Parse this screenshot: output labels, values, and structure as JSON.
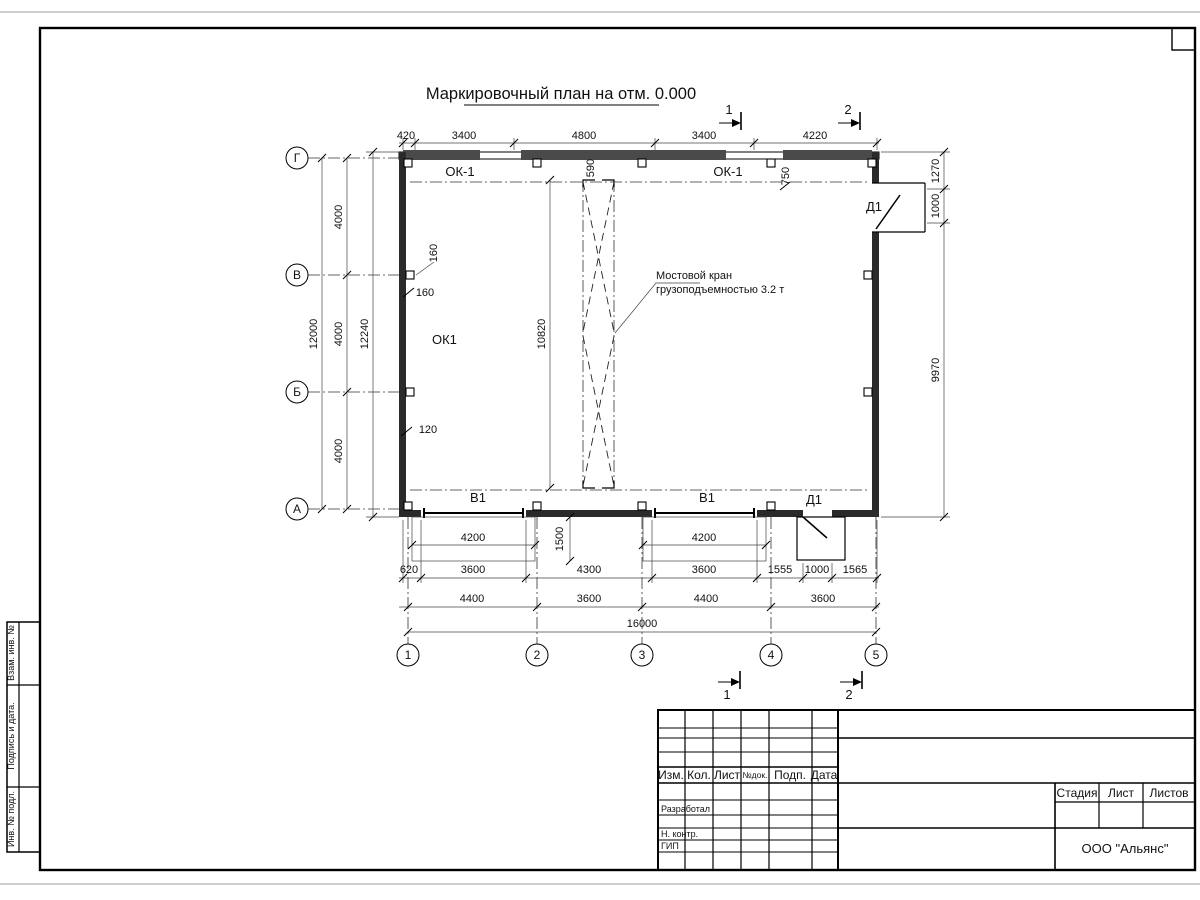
{
  "page": {
    "title": "Маркировочный план на отм. 0.000"
  },
  "axes": {
    "rows": [
      "Г",
      "В",
      "Б",
      "А"
    ],
    "cols": [
      "1",
      "2",
      "3",
      "4",
      "5"
    ]
  },
  "dims": {
    "top": [
      "420",
      "3400",
      "4800",
      "3400",
      "4220"
    ],
    "left_total": "12000",
    "left_segs": [
      "4000",
      "4000",
      "4000"
    ],
    "left_outer": "12240",
    "right": [
      "1270",
      "1000",
      "9970"
    ],
    "bottom1": [
      "620",
      "3600",
      "4300",
      "3600",
      "1555",
      "1000",
      "1565"
    ],
    "bottom2": [
      "4400",
      "3600",
      "4400",
      "3600"
    ],
    "bottom_total": "16000",
    "gate1_width": "4200",
    "gate2_width": "4200",
    "gate_depth": "1500",
    "crane_span": "10820",
    "d590": "590",
    "d750": "750",
    "d160a": "160",
    "d160b": "160",
    "d120": "120"
  },
  "marks": {
    "sec1": "1",
    "sec2": "2",
    "sec1b": "1",
    "sec2b": "2"
  },
  "labels": {
    "ok1_top_left": "ОК-1",
    "ok1_top_right": "ОК-1",
    "ok1_left": "ОК1",
    "d1_right": "Д1",
    "d1_bottom": "Д1",
    "v1_left": "В1",
    "v1_right": "В1",
    "crane1": "Мостовой кран",
    "crane2": "грузоподъемностью 3.2 т"
  },
  "title_block": {
    "hdr": [
      "Изм.",
      "Кол.",
      "Лист",
      "№док.",
      "Подп.",
      "Дата"
    ],
    "row_dev": "Разработал",
    "row_ncontr": "Н. контр.",
    "row_gip": "ГИП",
    "stage": [
      "Стадия",
      "Лист",
      "Листов"
    ],
    "company": "ООО \"Альянс\""
  },
  "side_stamp": {
    "r1": "Взам. инв. №",
    "r2": "Подпись  и  дата.",
    "r3": "Инв. № подл."
  }
}
